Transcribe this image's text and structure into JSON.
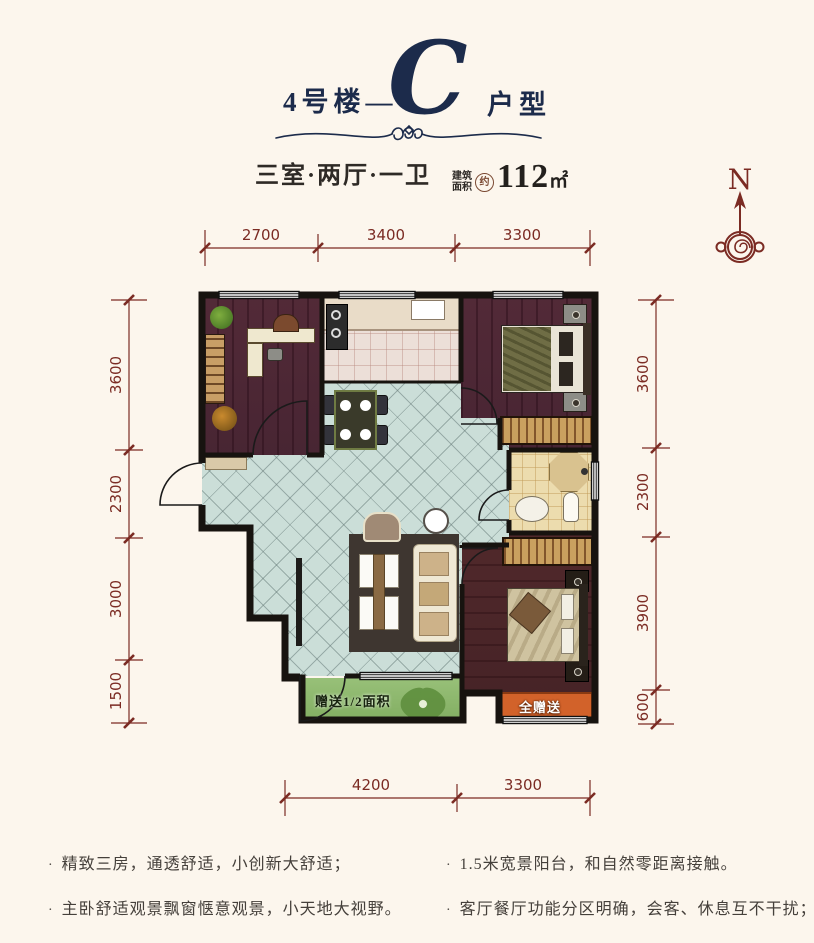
{
  "header": {
    "title_prefix": "4号楼—",
    "title_letter": "C",
    "title_suffix": "户型",
    "subtitle_rooms": "三室·两厅·一卫",
    "area_label_top": "建筑",
    "area_label_bottom": "面积",
    "area_approx": "约",
    "area_value": "112",
    "area_unit": "㎡"
  },
  "compass": {
    "north_label": "N"
  },
  "dimensions": {
    "top": [
      "2700",
      "3400",
      "3300"
    ],
    "left": [
      "3600",
      "2300",
      "3000",
      "1500"
    ],
    "right": [
      "3600",
      "2300",
      "3900",
      "600"
    ],
    "bottom": [
      "4200",
      "3300"
    ]
  },
  "plan": {
    "balcony_label": "赠送1/2面积",
    "bay_label": "全赠送"
  },
  "features": {
    "bullet": "·",
    "left": [
      "精致三房，通透舒适，小创新大舒适；",
      "主卧舒适观景飘窗惬意观景，小天地大视野。"
    ],
    "right": [
      "1.5米宽景阳台，和自然零距离接触。",
      "客厅餐厅功能分区明确，会客、休息互不干扰；"
    ]
  },
  "colors": {
    "navy": "#1c2b4b",
    "maroon": "#7b2b23",
    "wall": "#17130f",
    "tile": "#cbded8",
    "wood": "#5a3140",
    "balcony_green": "#8fbb6d",
    "bay_orange": "#d2622a",
    "bath_beige": "#ecdcae",
    "background": "#fcf6ed"
  }
}
